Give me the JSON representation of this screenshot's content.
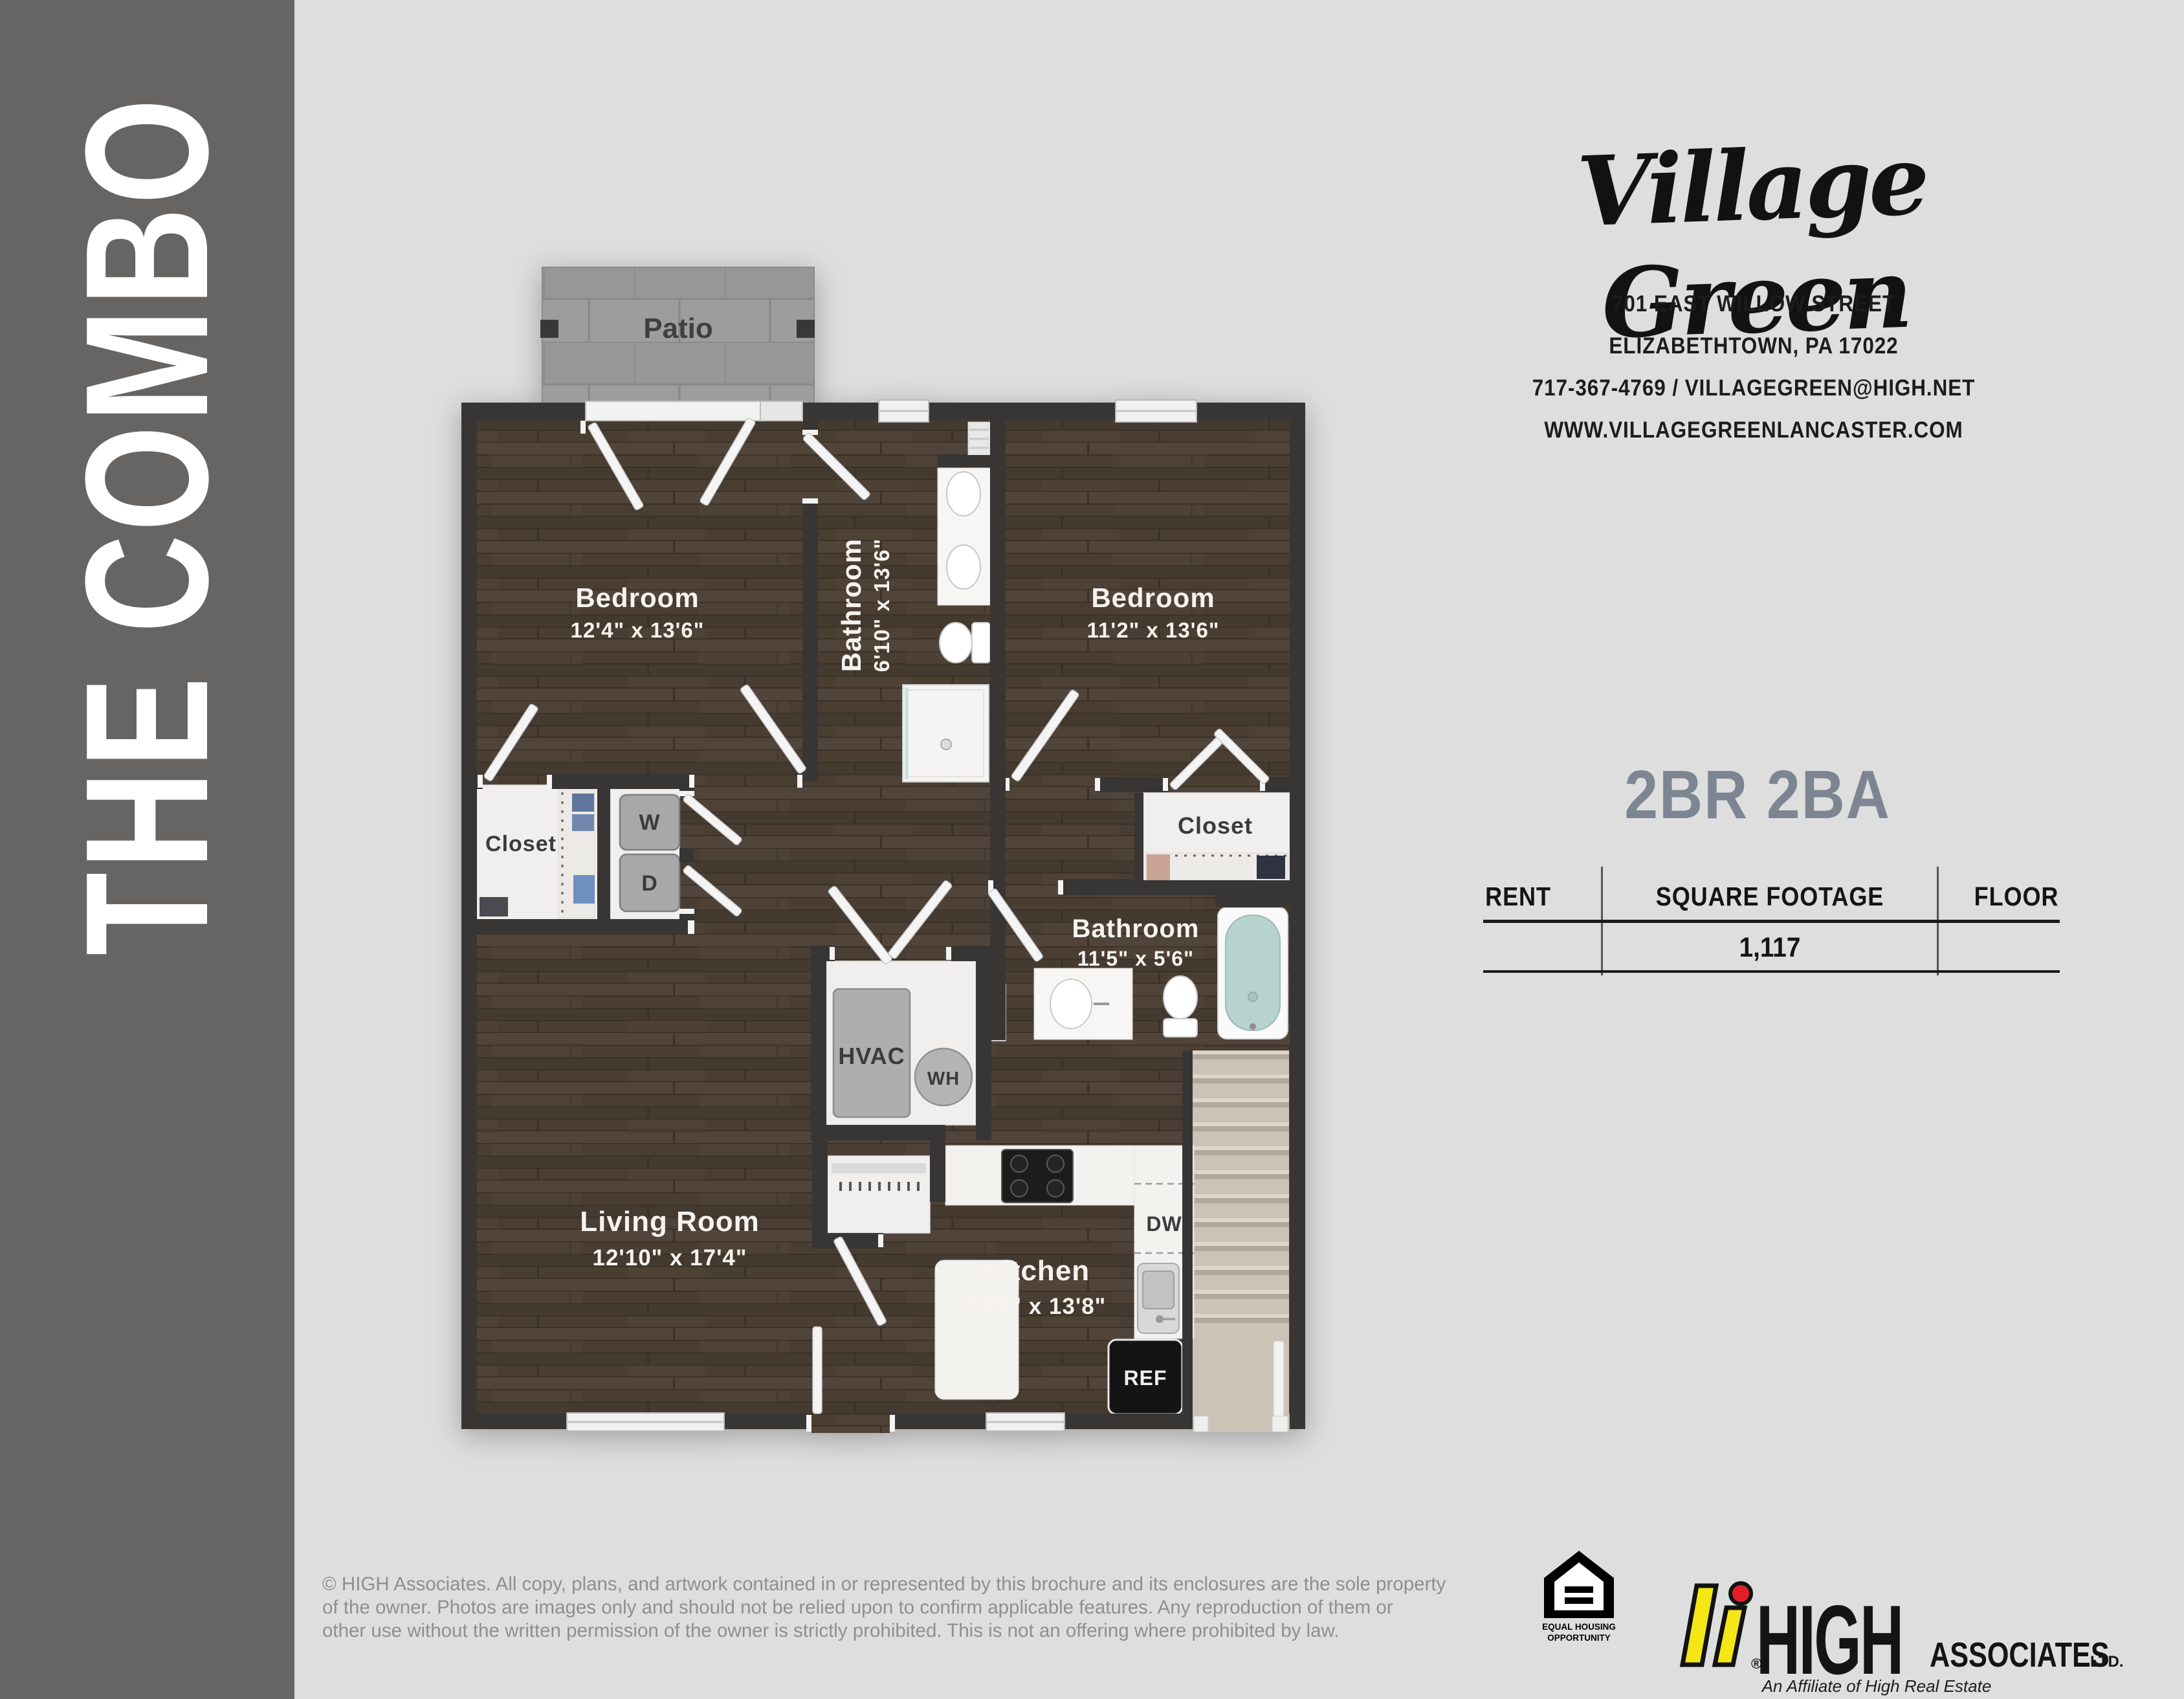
{
  "sidebar": {
    "title": "THE COMBO"
  },
  "brand": {
    "name": "Village Green",
    "address1": "701 EAST WILLOW STREET",
    "address2": "ELIZABETHTOWN, PA 17022",
    "address3": "717-367-4769 / VILLAGEGREEN@HIGH.NET",
    "address4": "WWW.VILLAGEGREENLANCASTER.COM"
  },
  "unit": {
    "type": "2BR 2BA",
    "table": {
      "col1": "RENT",
      "col2": "SQUARE FOOTAGE",
      "col3": "FLOOR",
      "rent": "",
      "square_footage": "1,117",
      "floor": ""
    }
  },
  "floorplan": {
    "patio": "Patio",
    "bedroom_left": {
      "name": "Bedroom",
      "dims": "12'4\" x 13'6\""
    },
    "bathroom_top": {
      "name": "Bathroom",
      "dims": "6'10\" x 13'6\""
    },
    "bedroom_right": {
      "name": "Bedroom",
      "dims": "11'2\" x 13'6\""
    },
    "closet_left": "Closet",
    "closet_right": "Closet",
    "washer": "W",
    "dryer": "D",
    "hvac": "HVAC",
    "water_heater": "WH",
    "bathroom_lower": {
      "name": "Bathroom",
      "dims": "11'5\" x 5'6\""
    },
    "living_room": {
      "name": "Living Room",
      "dims": "12'10\" x 17'4\""
    },
    "kitchen": {
      "name": "Kitchen",
      "dims": "13'8\" x 13'8\""
    },
    "dishwasher": "DW",
    "refrigerator": "REF"
  },
  "footer": {
    "line1": "© HIGH Associates. All copy, plans, and artwork contained in or represented by this brochure and its enclosures are the sole property",
    "line2": "of the owner. Photos are images only and should not be relied upon to confirm applicable features. Any reproduction of them or",
    "line3": "other use without the written permission of the owner is strictly prohibited. This is not an offering where prohibited by law.",
    "eho": {
      "line1": "EQUAL HOUSING",
      "line2": "OPPORTUNITY"
    },
    "high": {
      "name": "HIGH",
      "suffix": "ASSOCIATES",
      "ltd": "LTD.",
      "registered": "®",
      "tagline": "An Affiliate of High Real Estate Group LLC"
    }
  },
  "colors": {
    "background": "#dedede",
    "sidebar": "#666564",
    "walls": "#383634",
    "wood_floor": "#4a3e33",
    "patio_tile": "#9d9d9d",
    "stairs": "#cbc3b5",
    "tub_water": "#b6d3cd",
    "unit_type_accent": "#7d8593",
    "high_yellow": "#f5e616",
    "high_red": "#e31f26"
  }
}
